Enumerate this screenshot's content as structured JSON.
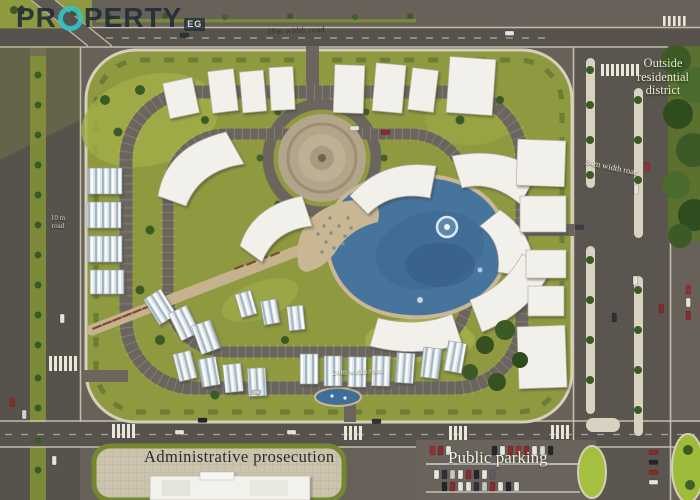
{
  "logo": {
    "prefix": "PR",
    "suffix": "PERTY",
    "badge": "EG",
    "o_icon": "house-circle-icon",
    "brand_teal": "#2fc7cb",
    "brand_navy": "#1f2b38"
  },
  "map_labels": {
    "top_road": "39m width road",
    "right_road": "84m width road",
    "left_road": "10 m road",
    "inner_road": "24m width road",
    "district": "Outside residential district",
    "admin_area": "Administrative prosecution",
    "parking_area": "Public parking"
  },
  "colors": {
    "asphalt": "#5f5954",
    "asphalt_dark": "#57524c",
    "interior_street": "#6b655e",
    "kerb": "#d6cfba",
    "median_green": "#7d8a38",
    "lawn": "#8f9940",
    "lawn_light": "#a5b24a",
    "tree": "#3c5a26",
    "building": "#f1f0ea",
    "roof_stripe": "#9fb6c4",
    "plaza_tan": "#b3a58a",
    "pool_blue": "#46749c",
    "deck_sand": "#c9b692",
    "hedge": "#5d7230",
    "car_red": "#8d2a2a",
    "car_white": "#e6e4de",
    "car_dark": "#23272d",
    "traffic_island_green": "#a4c03e"
  }
}
